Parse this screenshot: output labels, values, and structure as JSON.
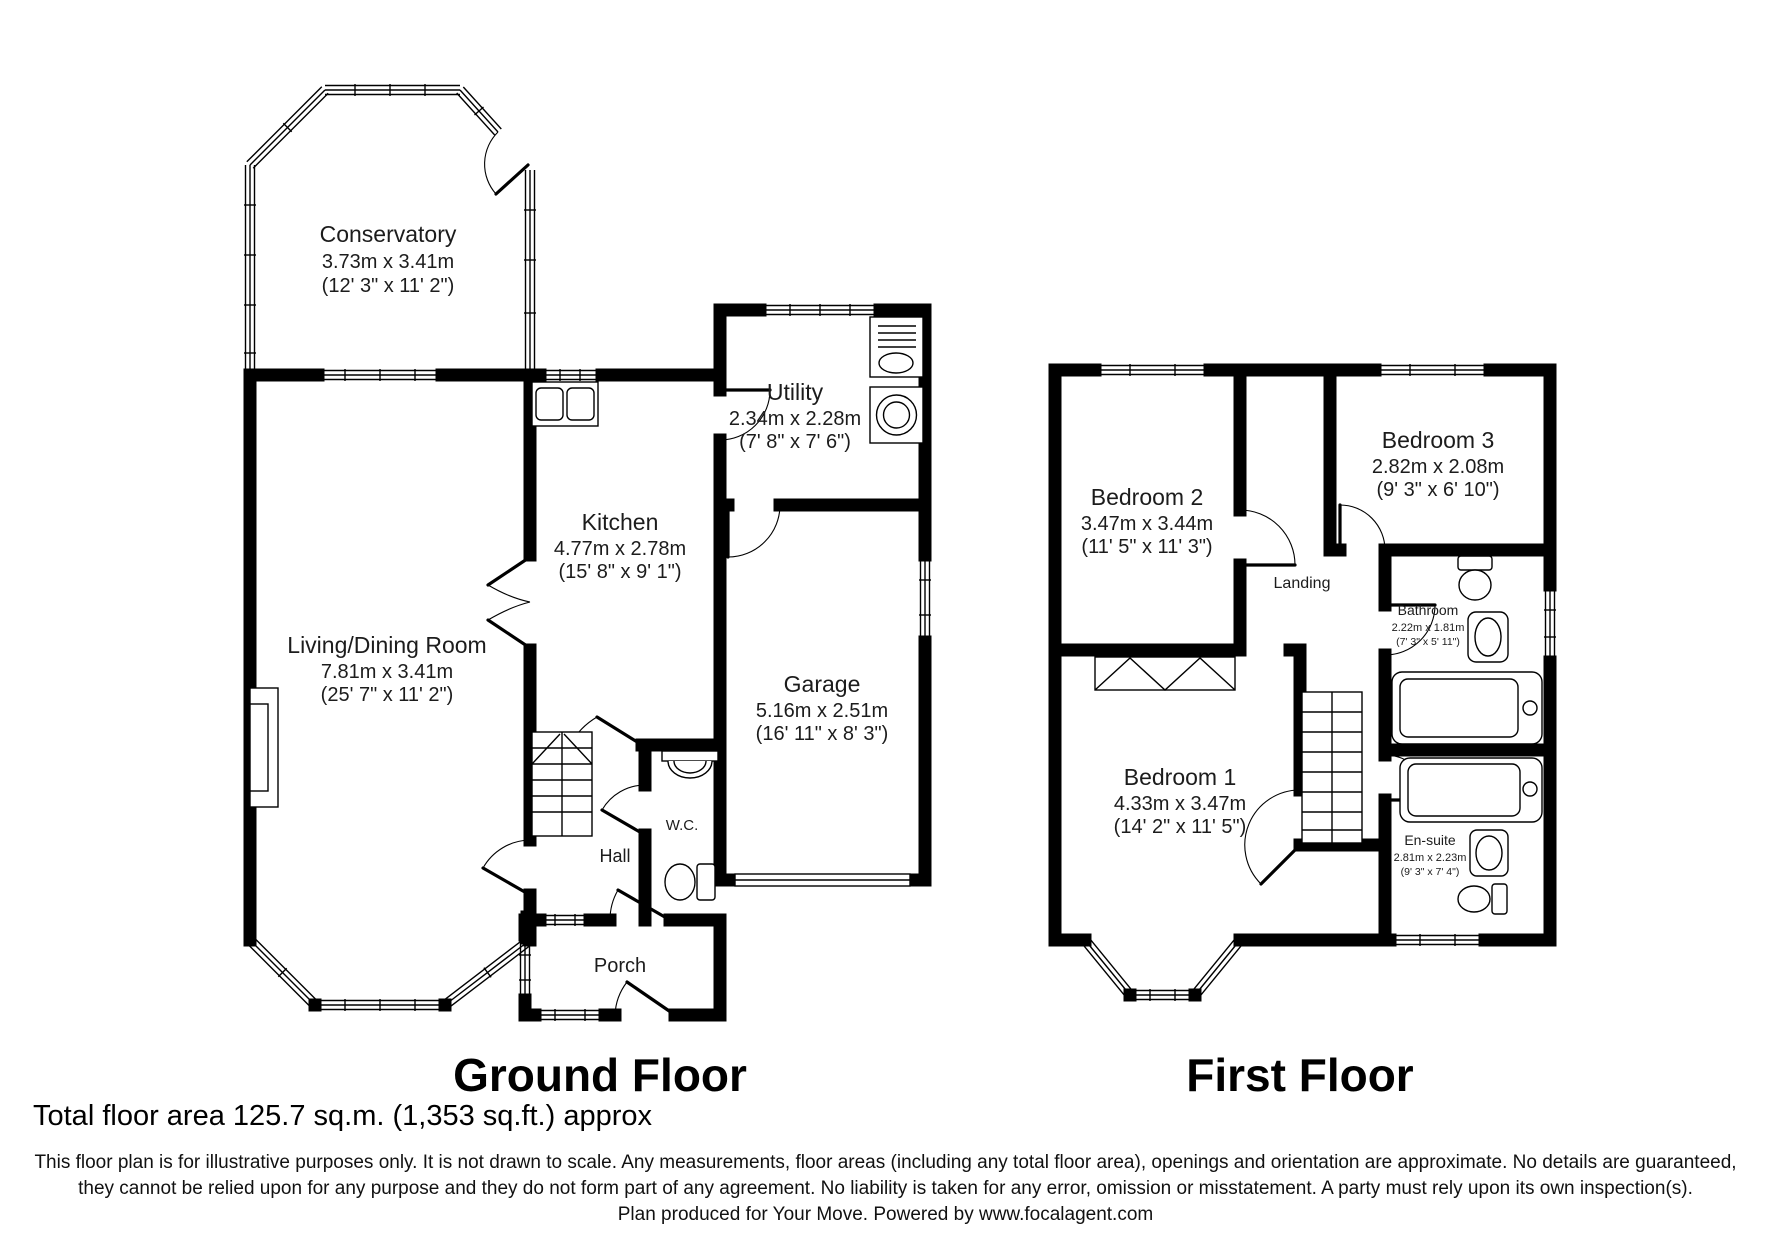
{
  "ground_floor": {
    "title": "Ground Floor",
    "rooms": {
      "conservatory": {
        "name": "Conservatory",
        "dims_m": "3.73m x 3.41m",
        "dims_ft": "(12' 3\" x 11' 2\")"
      },
      "living_dining": {
        "name": "Living/Dining Room",
        "dims_m": "7.81m x 3.41m",
        "dims_ft": "(25' 7\" x 11' 2\")"
      },
      "kitchen": {
        "name": "Kitchen",
        "dims_m": "4.77m x 2.78m",
        "dims_ft": "(15' 8\" x 9' 1\")"
      },
      "utility": {
        "name": "Utility",
        "dims_m": "2.34m x 2.28m",
        "dims_ft": "(7' 8\" x 7' 6\")"
      },
      "garage": {
        "name": "Garage",
        "dims_m": "5.16m x 2.51m",
        "dims_ft": "(16' 11\" x 8' 3\")"
      },
      "wc": {
        "name": "W.C."
      },
      "hall": {
        "name": "Hall"
      },
      "porch": {
        "name": "Porch"
      }
    }
  },
  "first_floor": {
    "title": "First Floor",
    "rooms": {
      "bedroom1": {
        "name": "Bedroom 1",
        "dims_m": "4.33m x 3.47m",
        "dims_ft": "(14' 2\" x 11' 5\")"
      },
      "bedroom2": {
        "name": "Bedroom 2",
        "dims_m": "3.47m x 3.44m",
        "dims_ft": "(11' 5\" x 11' 3\")"
      },
      "bedroom3": {
        "name": "Bedroom 3",
        "dims_m": "2.82m x 2.08m",
        "dims_ft": "(9' 3\" x 6' 10\")"
      },
      "bathroom": {
        "name": "Bathroom",
        "dims_m": "2.22m x 1.81m",
        "dims_ft": "(7' 3\" x 5' 11\")"
      },
      "ensuite": {
        "name": "En-suite",
        "dims_m": "2.81m x 2.23m",
        "dims_ft": "(9' 3\" x 7' 4\")"
      },
      "landing": {
        "name": "Landing"
      }
    }
  },
  "footer": {
    "total_area": "Total floor area 125.7 sq.m. (1,353 sq.ft.) approx",
    "disclaimer": [
      "This floor plan is for illustrative purposes only. It is not drawn to scale. Any measurements, floor areas (including any total floor area), openings and orientation are approximate. No details are guaranteed,",
      "they cannot be relied upon for any purpose and they do not form part of any agreement. No liability is taken for any error, omission or misstatement. A party must rely upon its own inspection(s).",
      "Plan produced for Your Move. Powered by www.focalagent.com"
    ]
  }
}
